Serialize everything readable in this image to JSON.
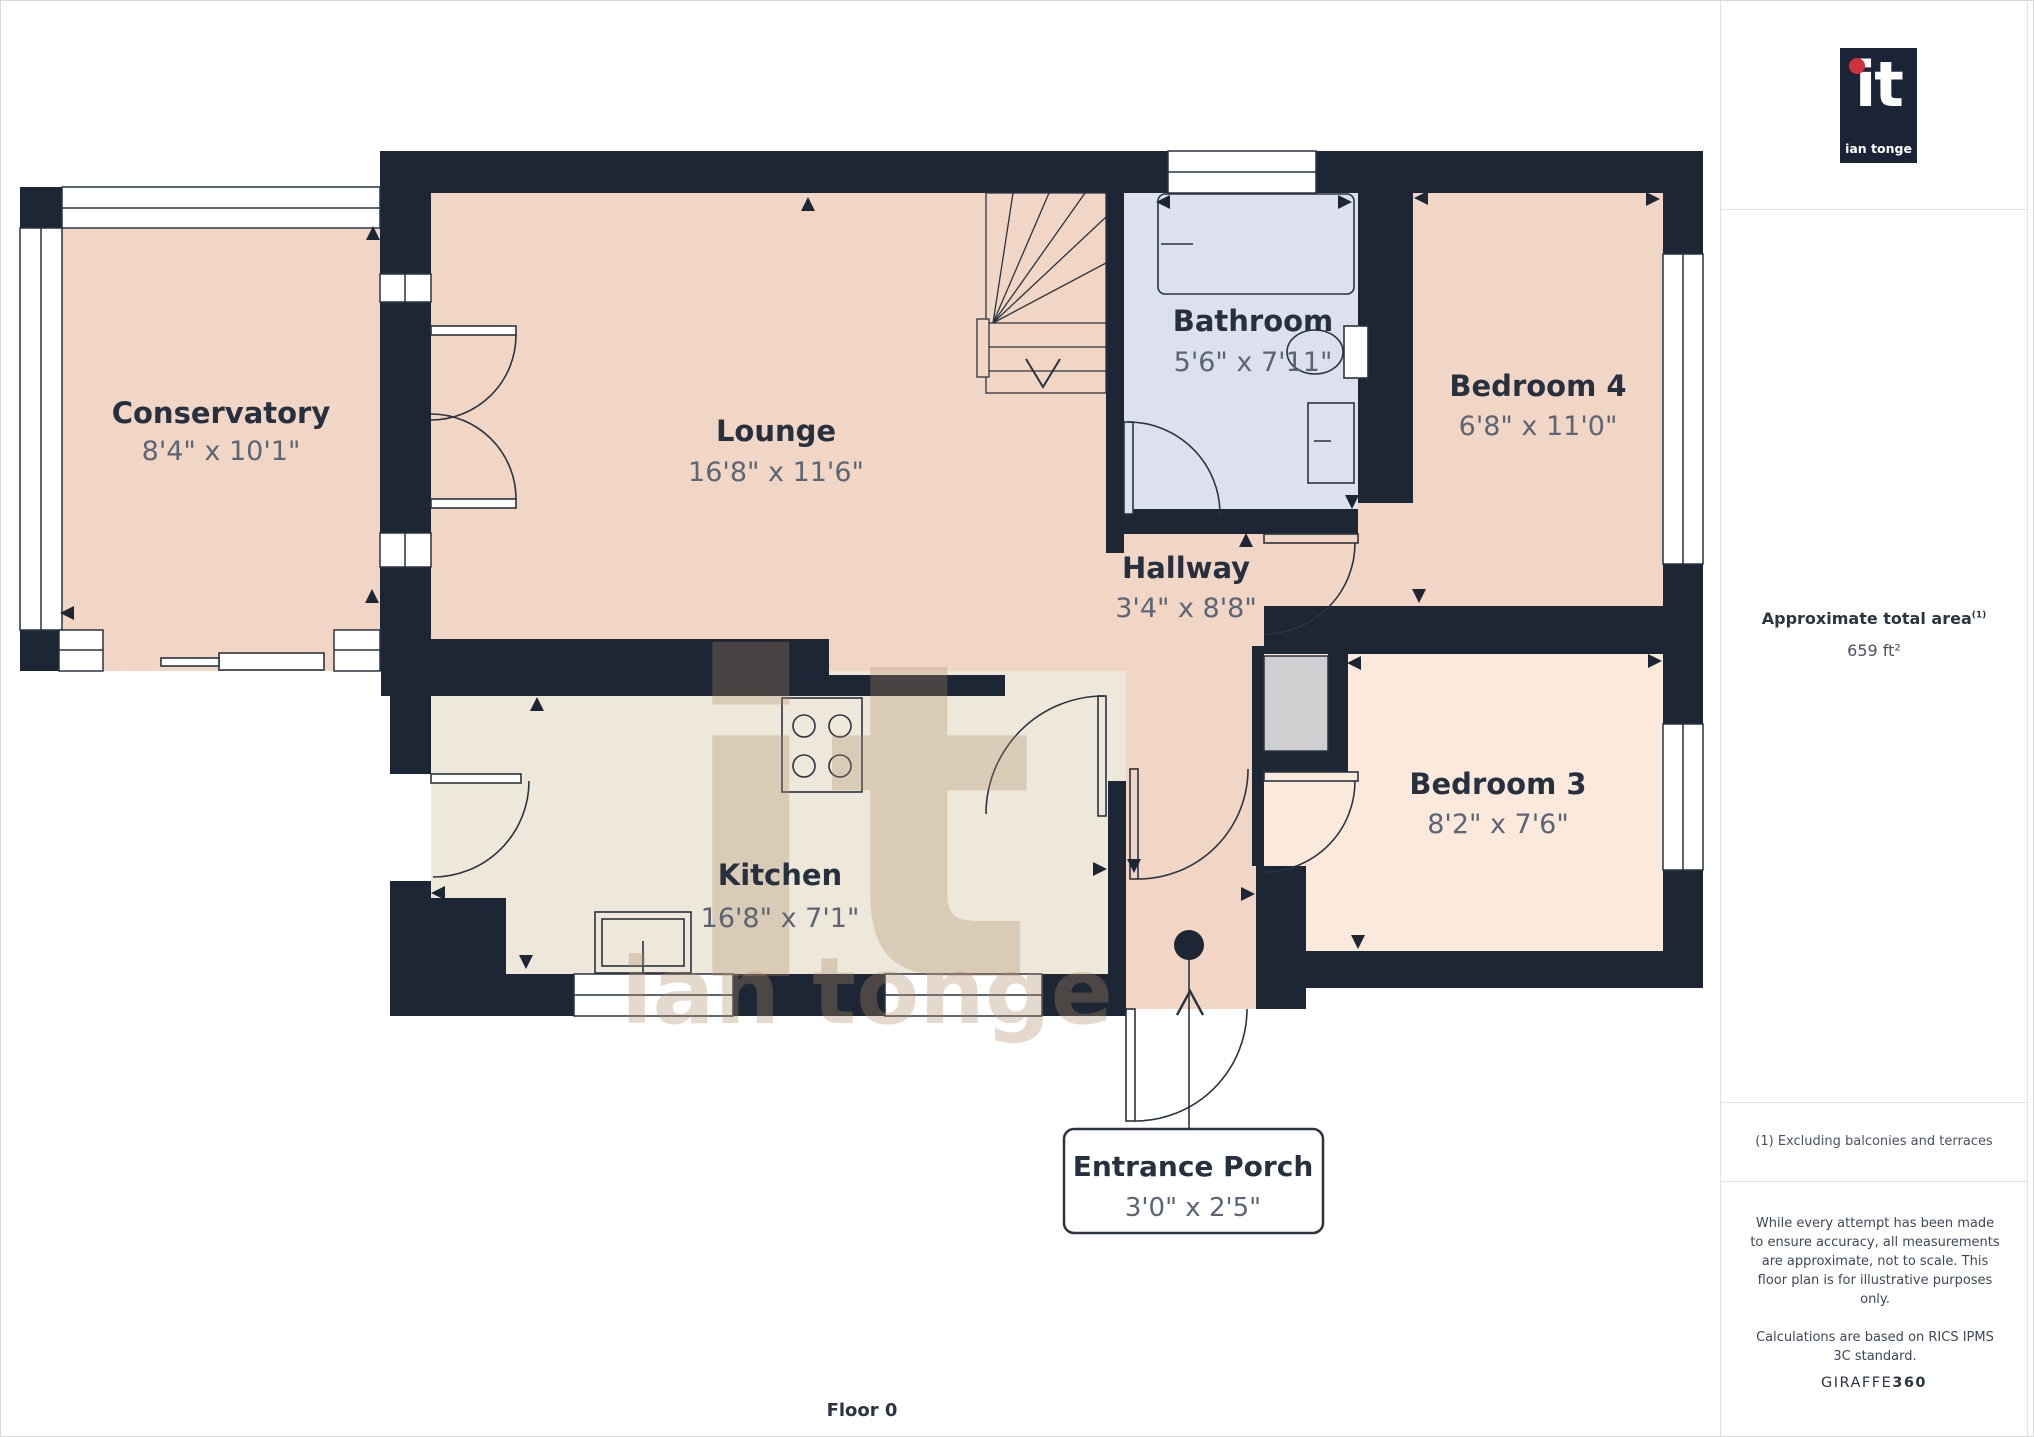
{
  "branding": {
    "logo_mark": "it",
    "logo_name": "ian tonge",
    "logo_background": "#1b2436",
    "logo_dot_color": "#cf3339"
  },
  "sidebar": {
    "area_title": "Approximate total area",
    "area_superscript": "(1)",
    "area_value": "659 ft²",
    "footnote": "(1) Excluding balconies and terraces",
    "disclaimer_para1": "While every attempt has been made to ensure accuracy, all measurements are approximate, not to scale. This floor plan is for illustrative purposes only.",
    "disclaimer_para2": "Calculations are based on RICS IPMS 3C standard.",
    "provider_name": "GIRAFFE",
    "provider_suffix": "360"
  },
  "plan": {
    "floor_label": "Floor 0",
    "watermark_mark": "it",
    "watermark_name": "ian tonge",
    "colors": {
      "wall": "#1d2634",
      "room_pink": "#f1d6c6",
      "room_cream": "#ede8d9",
      "room_peach": "#fbeadb",
      "room_blue": "#dce1ed",
      "cupboard_gray": "#cfcfd2",
      "label_navy": "#27303e",
      "dims_gray": "#5c6575"
    },
    "rooms": [
      {
        "name": "Conservatory",
        "dims": "8'4\" x 10'1\""
      },
      {
        "name": "Lounge",
        "dims": "16'8\" x 11'6\""
      },
      {
        "name": "Bathroom",
        "dims": "5'6\" x 7'11\""
      },
      {
        "name": "Bedroom 4",
        "dims": "6'8\" x 11'0\""
      },
      {
        "name": "Hallway",
        "dims": "3'4\" x 8'8\""
      },
      {
        "name": "Kitchen",
        "dims": "16'8\" x 7'1\""
      },
      {
        "name": "Bedroom 3",
        "dims": "8'2\" x 7'6\""
      },
      {
        "name": "Entrance Porch",
        "dims": "3'0\" x 2'5\""
      }
    ]
  }
}
